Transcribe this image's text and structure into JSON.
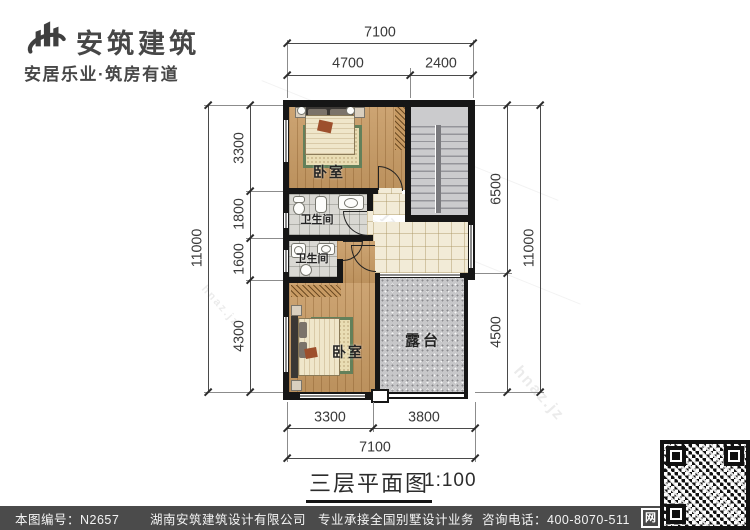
{
  "header": {
    "brand": "安筑建筑",
    "slogan": "安居乐业·筑房有道"
  },
  "plan": {
    "rooms": {
      "bedroom_top": "卧室",
      "bath_top": "卫生间",
      "bath_bottom": "卫生间",
      "bedroom_bottom": "卧室",
      "terrace": "露台"
    }
  },
  "dims": {
    "top": {
      "overall": "7100",
      "a": "4700",
      "b": "2400"
    },
    "left": {
      "overall": "11000",
      "s1": "3300",
      "s2": "1800",
      "s3": "1600",
      "s4": "4300"
    },
    "right": {
      "overall": "11000",
      "s1": "6500",
      "s2": "4500"
    },
    "bottom": {
      "a": "3300",
      "b": "3800",
      "overall": "7100"
    }
  },
  "caption": {
    "title": "三层平面图",
    "scale": "1:100"
  },
  "footer": {
    "sheet": "本图编号：N2657",
    "company": "湖南安筑建筑设计有限公司",
    "service": "专业承接全国别墅设计业务",
    "phone": "咨询电话：400-8070-511",
    "badge": "网"
  },
  "watermark": {
    "text": "hnaz.jz"
  },
  "colors": {
    "wall": "#161616",
    "wood": "#c79a63",
    "hall_tile": "#f2ebd7",
    "bath_tile": "#d9d8d3",
    "concrete": "#c7c7c9",
    "footer_bar": "#4b4b4b",
    "rug_border": "#63805a",
    "text": "#3a3a3a"
  }
}
